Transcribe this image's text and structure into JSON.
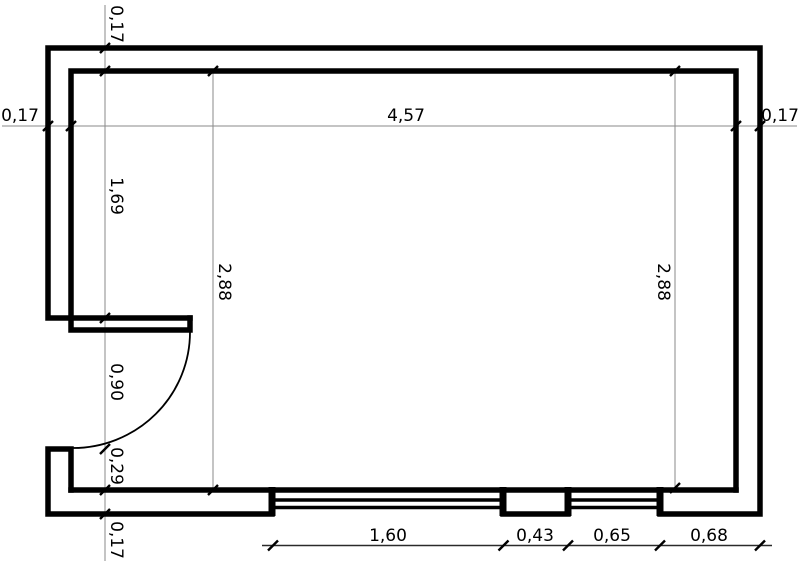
{
  "plan": {
    "title": "room-floor-plan",
    "colors": {
      "background": "#ffffff",
      "wall": "#000000",
      "dimension_line": "#8a8a8a",
      "dimension_chain_line": "#2a2a2a",
      "text": "#000000"
    },
    "dimensions": {
      "horizontal_chain": {
        "left_wall_thickness": "0,17",
        "interior_width": "4,57",
        "right_wall_thickness": "0,17"
      },
      "left_chain": {
        "top_wall_thickness": "0,17",
        "upper_wall_segment": "1,69",
        "door_opening": "0,90",
        "lower_wall_segment": "0,29",
        "bottom_wall_thickness": "0,17"
      },
      "interior_height_left": "2,88",
      "interior_height_right": "2,88",
      "bottom_chain": {
        "window_1_width": "1,60",
        "pier_width": "0,43",
        "window_2_width": "0,65",
        "right_segment_width": "0,68"
      }
    }
  }
}
